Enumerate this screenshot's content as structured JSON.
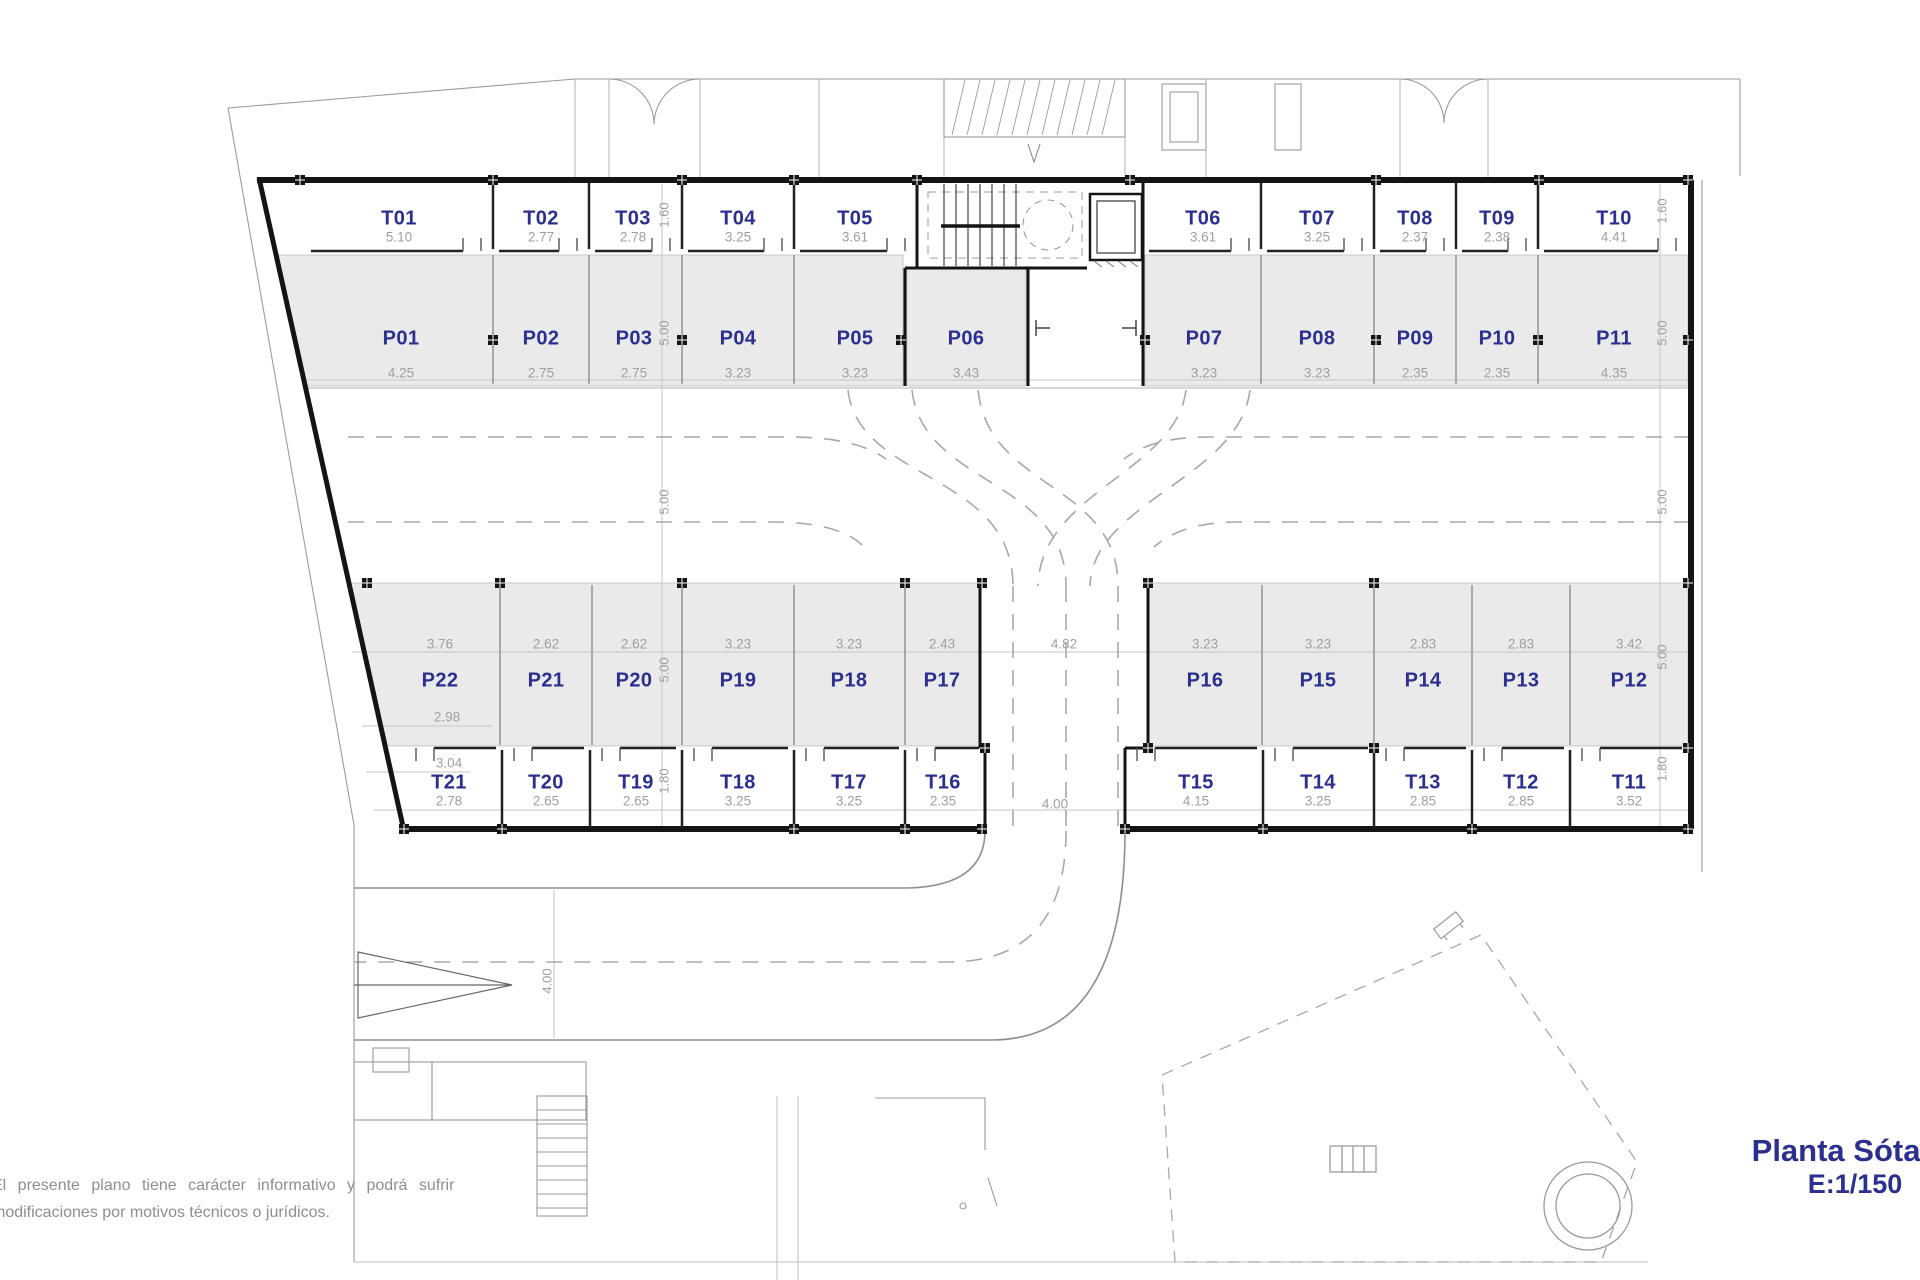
{
  "plan": {
    "title": "Planta Sótano",
    "scale": "E:1/150",
    "disclaimer_line1": "El presente plano tiene carácter informativo y podrá sufrir",
    "disclaimer_line2": "modificaciones por motivos técnicos o jurídicos.",
    "colors": {
      "room_label": "#2b2f8f",
      "dim_text": "#9f9f9f",
      "parking_fill": "#eaeaea",
      "wall": "#141414"
    }
  },
  "rooms": {
    "storage_top": [
      {
        "id": "T01",
        "label": "T01",
        "dim": "5.10"
      },
      {
        "id": "T02",
        "label": "T02",
        "dim": "2.77"
      },
      {
        "id": "T03",
        "label": "T03",
        "dim": "2.78"
      },
      {
        "id": "T04",
        "label": "T04",
        "dim": "3.25"
      },
      {
        "id": "T05",
        "label": "T05",
        "dim": "3.61"
      },
      {
        "id": "T06",
        "label": "T06",
        "dim": "3.61"
      },
      {
        "id": "T07",
        "label": "T07",
        "dim": "3.25"
      },
      {
        "id": "T08",
        "label": "T08",
        "dim": "2.37"
      },
      {
        "id": "T09",
        "label": "T09",
        "dim": "2.38"
      },
      {
        "id": "T10",
        "label": "T10",
        "dim": "4.41"
      }
    ],
    "parking_top": [
      {
        "id": "P01",
        "label": "P01",
        "dim": "4.25"
      },
      {
        "id": "P02",
        "label": "P02",
        "dim": "2.75"
      },
      {
        "id": "P03",
        "label": "P03",
        "dim": "2.75"
      },
      {
        "id": "P04",
        "label": "P04",
        "dim": "3.23"
      },
      {
        "id": "P05",
        "label": "P05",
        "dim": "3.23"
      },
      {
        "id": "P06",
        "label": "P06",
        "dim": "3.43"
      },
      {
        "id": "P07",
        "label": "P07",
        "dim": "3.23"
      },
      {
        "id": "P08",
        "label": "P08",
        "dim": "3.23"
      },
      {
        "id": "P09",
        "label": "P09",
        "dim": "2.35"
      },
      {
        "id": "P10",
        "label": "P10",
        "dim": "2.35"
      },
      {
        "id": "P11",
        "label": "P11",
        "dim": "4.35"
      }
    ],
    "parking_bottom": [
      {
        "id": "P22",
        "label": "P22",
        "dim": "3.76"
      },
      {
        "id": "P21",
        "label": "P21",
        "dim": "2.62"
      },
      {
        "id": "P20",
        "label": "P20",
        "dim": "2.62"
      },
      {
        "id": "P19",
        "label": "P19",
        "dim": "3.23"
      },
      {
        "id": "P18",
        "label": "P18",
        "dim": "3.23"
      },
      {
        "id": "P17",
        "label": "P17",
        "dim": "2.43"
      },
      {
        "id": "P16",
        "label": "P16",
        "dim": "3.23"
      },
      {
        "id": "P15",
        "label": "P15",
        "dim": "3.23"
      },
      {
        "id": "P14",
        "label": "P14",
        "dim": "2.83"
      },
      {
        "id": "P13",
        "label": "P13",
        "dim": "2.83"
      },
      {
        "id": "P12",
        "label": "P12",
        "dim": "3.42"
      }
    ],
    "storage_bottom": [
      {
        "id": "T21",
        "label": "T21",
        "dim": "2.78"
      },
      {
        "id": "T20",
        "label": "T20",
        "dim": "2.65"
      },
      {
        "id": "T19",
        "label": "T19",
        "dim": "2.65"
      },
      {
        "id": "T18",
        "label": "T18",
        "dim": "3.25"
      },
      {
        "id": "T17",
        "label": "T17",
        "dim": "3.25"
      },
      {
        "id": "T16",
        "label": "T16",
        "dim": "2.35"
      },
      {
        "id": "T15",
        "label": "T15",
        "dim": "4.15"
      },
      {
        "id": "T14",
        "label": "T14",
        "dim": "3.25"
      },
      {
        "id": "T13",
        "label": "T13",
        "dim": "2.85"
      },
      {
        "id": "T12",
        "label": "T12",
        "dim": "2.85"
      },
      {
        "id": "T11",
        "label": "T11",
        "dim": "3.52"
      }
    ]
  },
  "dims": {
    "left_line": [
      "1.60",
      "5.00",
      "5.00",
      "5.00",
      "1.80"
    ],
    "right_line": [
      "1.60",
      "5.00",
      "5.00",
      "5.00",
      "1.80"
    ],
    "extras": [
      "2.98",
      "3.04",
      "4.82",
      "4.00",
      "4.00"
    ]
  }
}
